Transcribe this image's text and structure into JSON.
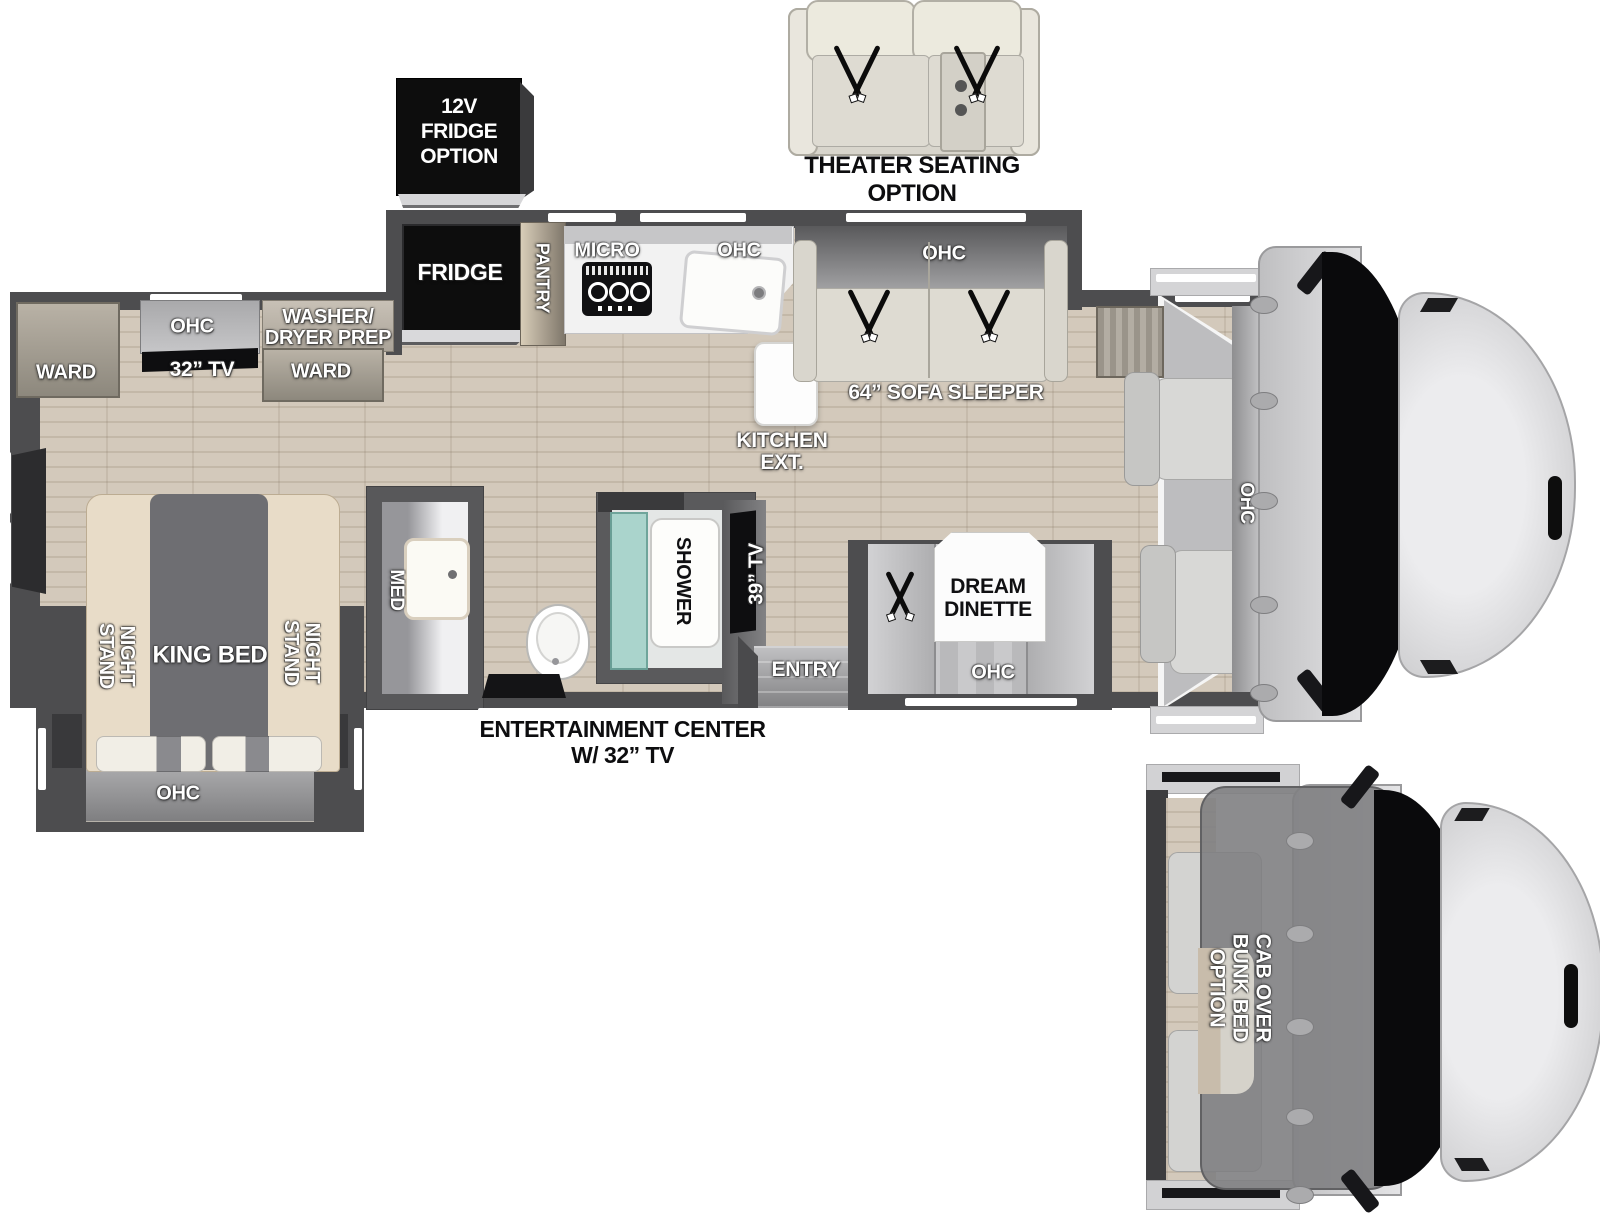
{
  "captions": {
    "theater": [
      "THEATER SEATING",
      "OPTION"
    ],
    "fridge12v": [
      "12V",
      "FRIDGE",
      "OPTION"
    ],
    "entertainment": [
      "ENTERTAINMENT CENTER",
      "W/ 32” TV"
    ],
    "cab_over_bunk": [
      "CAB OVER",
      "BUNK BED",
      "OPTION"
    ]
  },
  "kitchen": {
    "fridge": "FRIDGE",
    "pantry": "PANTRY",
    "micro": "MICRO",
    "ohc": "OHC",
    "ext": [
      "KITCHEN",
      "EXT."
    ]
  },
  "living": {
    "sofa_ohc": "OHC",
    "sofa": "64” SOFA SLEEPER",
    "dinette": [
      "DREAM",
      "DINETTE"
    ],
    "dinette_ohc": "OHC",
    "tv": "39” TV",
    "entry": "ENTRY"
  },
  "bath": {
    "shower": "SHOWER",
    "med": "MED"
  },
  "bedroom": {
    "ward_left": "WARD",
    "ohc": "OHC",
    "tv": "32” TV",
    "washer_dryer": [
      "WASHER/",
      "DRYER PREP"
    ],
    "ward_right": "WARD",
    "night_stand": [
      "NIGHT",
      "STAND"
    ],
    "king_bed": "KING BED",
    "slide_ohc": "OHC"
  },
  "cab": {
    "ohc": "OHC"
  },
  "colors": {
    "wall": "#4d4d4f",
    "floor_wood": "#cdc3b5",
    "black_appliance": "#0d0d0d",
    "sofa_beige": "#dedbd2",
    "shower_glass": "#a5d0c9"
  }
}
